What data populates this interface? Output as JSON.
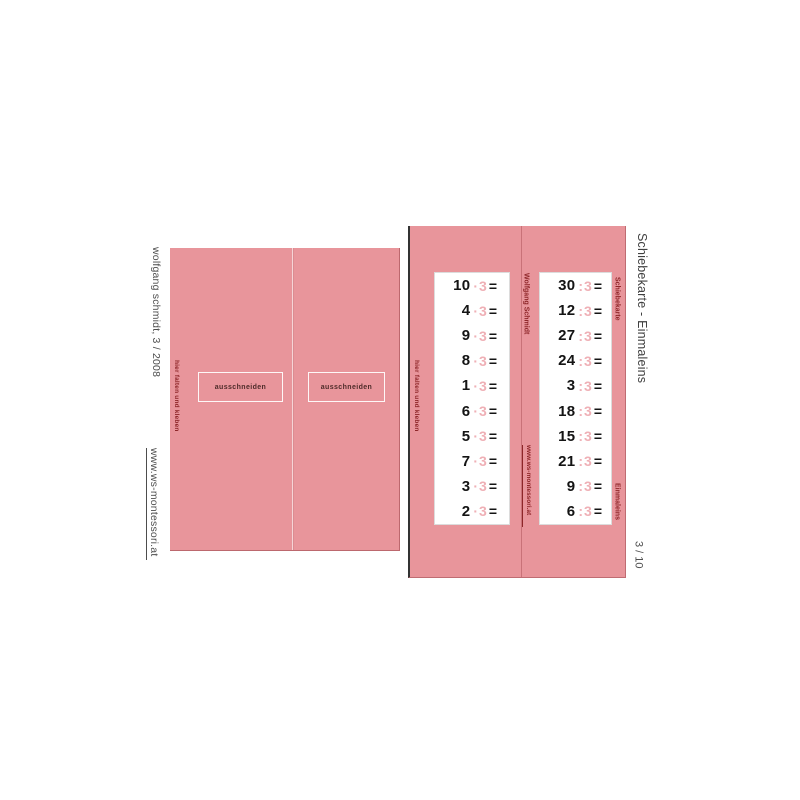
{
  "document": {
    "side_title": "Schiebekarte - Einmaleins",
    "page_number": "3 / 10",
    "author_credit": "wolfgang schmidt, 3 / 2008",
    "website": "www.ws-montessori.at"
  },
  "fold_panel_left": {
    "fold_instruction": "hier falten und kleben",
    "cut_box_1": "ausschneiden",
    "cut_box_2": "ausschneiden"
  },
  "fold_panel_right": {
    "fold_instruction": "hier falten und kleben",
    "author": "Wolfgang Schmidt",
    "website": "www.ws-montessori.at",
    "series_label": "Schiebekarte",
    "topic_label": "Einmaleins"
  },
  "problems": {
    "multiplication": {
      "values": [
        10,
        4,
        9,
        8,
        1,
        6,
        5,
        7,
        3,
        2
      ],
      "operator": "·",
      "operand": "3",
      "equals": "="
    },
    "division": {
      "values": [
        30,
        12,
        27,
        24,
        3,
        18,
        15,
        21,
        9,
        6
      ],
      "operator": ":",
      "operand": "3",
      "equals": "="
    }
  },
  "colors": {
    "panel_pink": "#e8959b",
    "accent_pink": "#efb0b6",
    "dark_red": "#8e2629",
    "text_gray": "#4d4d4d"
  }
}
